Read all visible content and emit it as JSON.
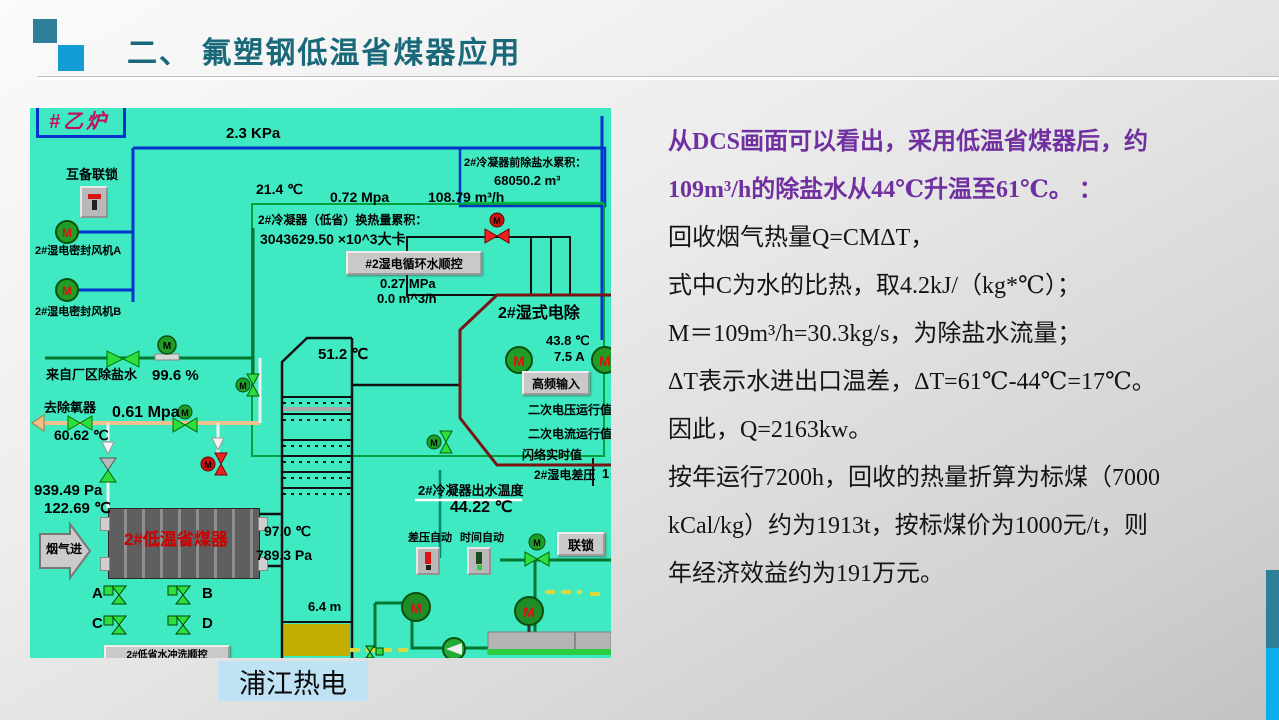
{
  "slide": {
    "title": "二、 氟塑钢低温省煤器应用",
    "caption": "浦江热电",
    "colors": {
      "title_teal": "#19697a",
      "accent_square_dark": "#2e7e98",
      "accent_square_light": "#139dd4",
      "purple_text": "#7030a0",
      "dcs_background": "#3fe9c2",
      "pipe_blue": "#0033cc",
      "pipe_green": "#00772e",
      "vessel_maroon": "#7a1515",
      "economizer_red": "#cc0000",
      "caption_background": "#bfe3f5"
    }
  },
  "right_text": {
    "lines": [
      {
        "color": "purple",
        "text": "从DCS画面可以看出，采用低温省煤器后，约"
      },
      {
        "color": "purple",
        "text": "109m³/h的除盐水从44℃升温至61℃。 ："
      },
      {
        "color": "black",
        "text": "回收烟气热量Q=CMΔT，"
      },
      {
        "color": "black",
        "text": "式中C为水的比热，取4.2kJ/（kg*℃）；"
      },
      {
        "color": "black",
        "text": "M＝109m³/h=30.3kg/s，为除盐水流量；"
      },
      {
        "color": "black",
        "text": "ΔT表示水进出口温差，ΔT=61℃-44℃=17℃。"
      },
      {
        "color": "black",
        "text": "因此，Q=2163kw。"
      },
      {
        "color": "black",
        "text": "按年运行7200h，回收的热量折算为标煤（7000"
      },
      {
        "color": "black",
        "text": "kCal/kg）约为1913t，按标煤价为1000元/t，则"
      },
      {
        "color": "black",
        "text": "年经济效益约为191万元。"
      }
    ]
  },
  "dcs": {
    "motor_letter": "M",
    "boxes": {
      "boiler_tag": "#乙炉"
    },
    "labels": [
      {
        "name": "pressure-top",
        "text": "2.3 KPa",
        "x": 196,
        "y": 18,
        "size": 15
      },
      {
        "name": "interlock-label",
        "text": "互备联锁",
        "x": 36,
        "y": 60,
        "size": 13
      },
      {
        "name": "fan-a-label",
        "text": "2#湿电密封风机A",
        "x": 5,
        "y": 138,
        "size": 11
      },
      {
        "name": "fan-b-label",
        "text": "2#湿电密封风机B",
        "x": 5,
        "y": 199,
        "size": 11
      },
      {
        "name": "temp-inlet",
        "text": "21.4 ℃",
        "x": 226,
        "y": 74,
        "size": 14
      },
      {
        "name": "press-072",
        "text": "0.72 Mpa",
        "x": 300,
        "y": 82,
        "size": 14
      },
      {
        "name": "flow-10879",
        "text": "108.79 m³/h",
        "x": 398,
        "y": 82,
        "size": 14
      },
      {
        "name": "demin-total-title",
        "text": "2#冷凝器前除盐水累积：",
        "x": 434,
        "y": 50,
        "size": 11
      },
      {
        "name": "demin-total-value",
        "text": "68050.2 m³",
        "x": 464,
        "y": 66,
        "size": 13
      },
      {
        "name": "heat-total-title",
        "text": "2#冷凝器（低省）换热量累积：",
        "x": 228,
        "y": 106,
        "size": 12
      },
      {
        "name": "heat-total-value",
        "text": "3043629.50 ×10^3大卡",
        "x": 230,
        "y": 124,
        "size": 14
      },
      {
        "name": "press-027",
        "text": "0.27 MPa",
        "x": 350,
        "y": 169,
        "size": 13
      },
      {
        "name": "flow-00",
        "text": "0.0 m^3/h",
        "x": 347,
        "y": 184,
        "size": 13
      },
      {
        "name": "esp-title",
        "text": "2#湿式电除",
        "x": 468,
        "y": 198,
        "size": 16
      },
      {
        "name": "esp-temp",
        "text": "43.8 ℃",
        "x": 516,
        "y": 226,
        "size": 13
      },
      {
        "name": "esp-current",
        "text": "7.5 A",
        "x": 524,
        "y": 242,
        "size": 13
      },
      {
        "name": "sec-voltage-label",
        "text": "二次电压运行值",
        "x": 498,
        "y": 296,
        "size": 12
      },
      {
        "name": "sec-current-label",
        "text": "二次电流运行值",
        "x": 498,
        "y": 320,
        "size": 12
      },
      {
        "name": "flashover-label",
        "text": "闪络实时值",
        "x": 492,
        "y": 341,
        "size": 12
      },
      {
        "name": "esp-dp-label",
        "text": "2#湿电差压",
        "x": 504,
        "y": 361,
        "size": 12
      },
      {
        "name": "esp-dp-value",
        "text": "1",
        "x": 572,
        "y": 359,
        "size": 13
      },
      {
        "name": "temp-512",
        "text": "51.2 ℃",
        "x": 288,
        "y": 239,
        "size": 15
      },
      {
        "name": "from-plant-label",
        "text": "来自厂区除盐水",
        "x": 16,
        "y": 260,
        "size": 13
      },
      {
        "name": "percent-996",
        "text": "99.6 %",
        "x": 122,
        "y": 260,
        "size": 15
      },
      {
        "name": "deaerator-label",
        "text": "去除氧器",
        "x": 14,
        "y": 293,
        "size": 13
      },
      {
        "name": "press-061",
        "text": "0.61 Mpa",
        "x": 82,
        "y": 297,
        "size": 16
      },
      {
        "name": "temp-6062",
        "text": "60.62 ℃",
        "x": 24,
        "y": 320,
        "size": 14
      },
      {
        "name": "press-93949",
        "text": "939.49 Pa",
        "x": 4,
        "y": 375,
        "size": 15
      },
      {
        "name": "temp-12269",
        "text": "122.69 ℃",
        "x": 14,
        "y": 393,
        "size": 15
      },
      {
        "name": "flue-in-label",
        "text": "烟气进",
        "x": 16,
        "y": 435,
        "size": 12
      },
      {
        "name": "economizer-name",
        "text": "2#低温省煤器",
        "x": 94,
        "y": 423,
        "size": 17,
        "color": "#cc0000"
      },
      {
        "name": "temp-97",
        "text": "97.0 ℃",
        "x": 234,
        "y": 416,
        "size": 14
      },
      {
        "name": "press-7893",
        "text": "789.3 Pa",
        "x": 226,
        "y": 440,
        "size": 14
      },
      {
        "name": "valve-a-label",
        "text": "A",
        "x": 62,
        "y": 478,
        "size": 15
      },
      {
        "name": "valve-b-label",
        "text": "B",
        "x": 172,
        "y": 478,
        "size": 15
      },
      {
        "name": "valve-c-label",
        "text": "C",
        "x": 62,
        "y": 508,
        "size": 15
      },
      {
        "name": "valve-d-label",
        "text": "D",
        "x": 172,
        "y": 508,
        "size": 15
      },
      {
        "name": "cond-out-label",
        "text": "2#冷凝器出水温度",
        "x": 388,
        "y": 376,
        "size": 13
      },
      {
        "name": "cond-out-value",
        "text": "44.22 ℃",
        "x": 420,
        "y": 392,
        "size": 16
      },
      {
        "name": "dp-auto-label",
        "text": "差压自动",
        "x": 378,
        "y": 425,
        "size": 11
      },
      {
        "name": "time-auto-label",
        "text": "时间自动",
        "x": 430,
        "y": 425,
        "size": 11
      },
      {
        "name": "tank-level",
        "text": "6.4 m",
        "x": 278,
        "y": 492,
        "size": 13
      }
    ],
    "buttons": [
      {
        "name": "circ-water-seq-button",
        "text": "#2湿电循环水顺控",
        "x": 316,
        "y": 143,
        "w": 132,
        "h": 20,
        "size": 12
      },
      {
        "name": "hf-input-button",
        "text": "高频输入",
        "x": 492,
        "y": 263,
        "w": 64,
        "h": 20,
        "size": 12
      },
      {
        "name": "interlock-button",
        "text": "联锁",
        "x": 527,
        "y": 424,
        "w": 44,
        "h": 20,
        "size": 13
      },
      {
        "name": "wash-seq-button",
        "text": "2#低省水冲洗顺控",
        "x": 74,
        "y": 537,
        "w": 122,
        "h": 13,
        "size": 10
      }
    ]
  }
}
